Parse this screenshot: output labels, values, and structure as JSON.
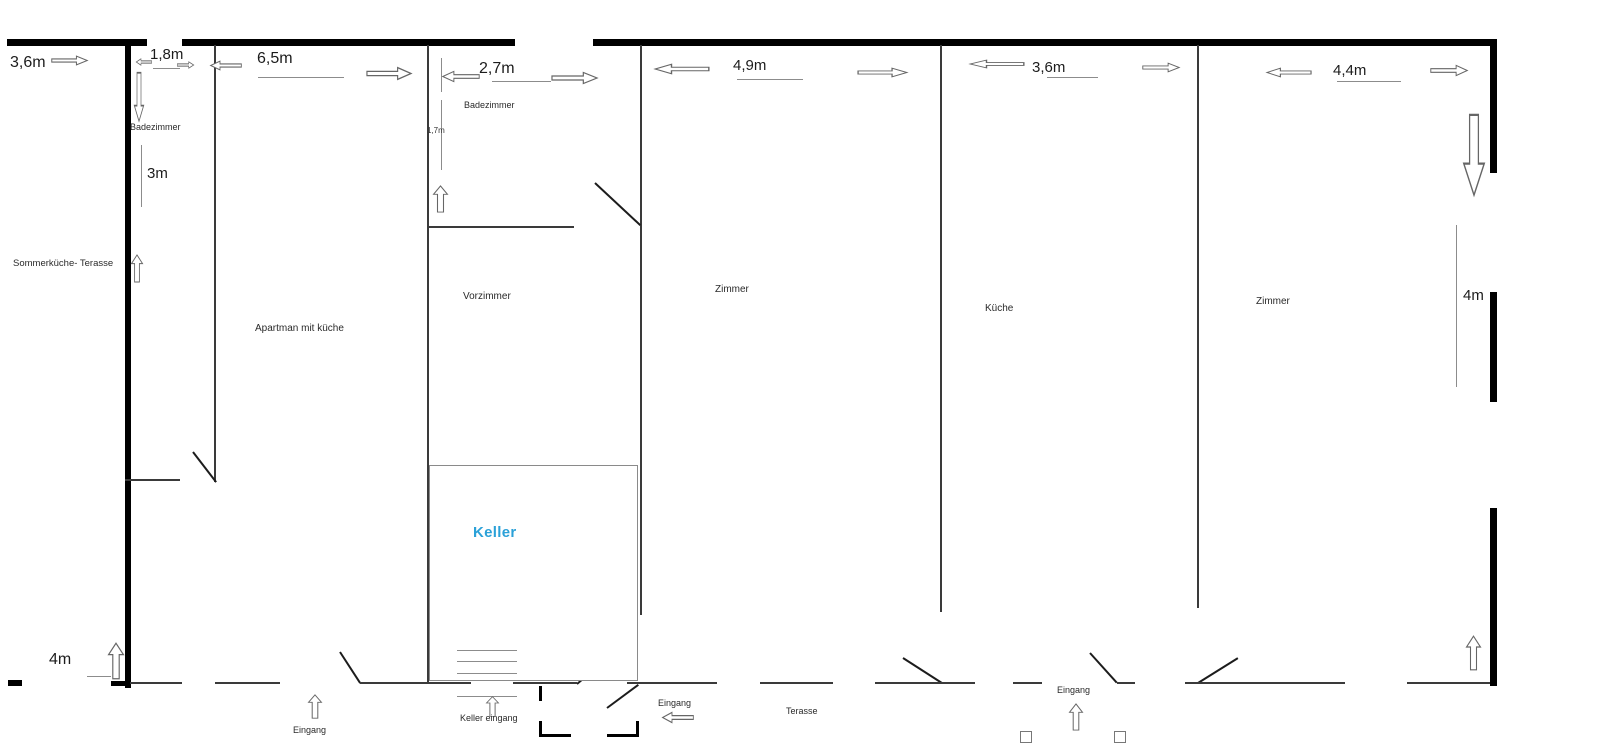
{
  "colors": {
    "wall": "#000000",
    "keller-text": "#2ba1d8"
  },
  "labels": {
    "badezimmer_left": "Badezimmer",
    "sommerkueche_terasse": "Sommerküche- Terasse",
    "apartman_mit_kueche": "Apartman mit küche",
    "badezimmer_mid": "Badezimmer",
    "vorzimmer": "Vorzimmer",
    "zimmer_left": "Zimmer",
    "kueche": "Küche",
    "zimmer_right": "Zimmer",
    "keller": "Keller",
    "terasse": "Terasse",
    "eingang_left": "Eingang",
    "keller_eingang": "Keller eingang",
    "eingang_mid": "Eingang",
    "eingang_right": "Eingang"
  },
  "dimensions": {
    "sommer_width": "3,6m",
    "bad_left_width": "1,8m",
    "bad_left_depth": "3m",
    "apartman_width": "6,5m",
    "bad_mid_width": "2,7m",
    "bad_mid_depth": "1,7m",
    "zimmer_left_width": "4,9m",
    "kueche_width": "3,6m",
    "zimmer_right_width": "4,4m",
    "zimmer_right_depth": "4m",
    "left_entry_width": "4m"
  },
  "icons": {
    "arrow_right": "outline-block-arrow-right",
    "arrow_left": "outline-block-arrow-left",
    "arrow_up": "outline-block-arrow-up",
    "arrow_down": "outline-block-arrow-down",
    "square_marker": "small-outline-square"
  }
}
